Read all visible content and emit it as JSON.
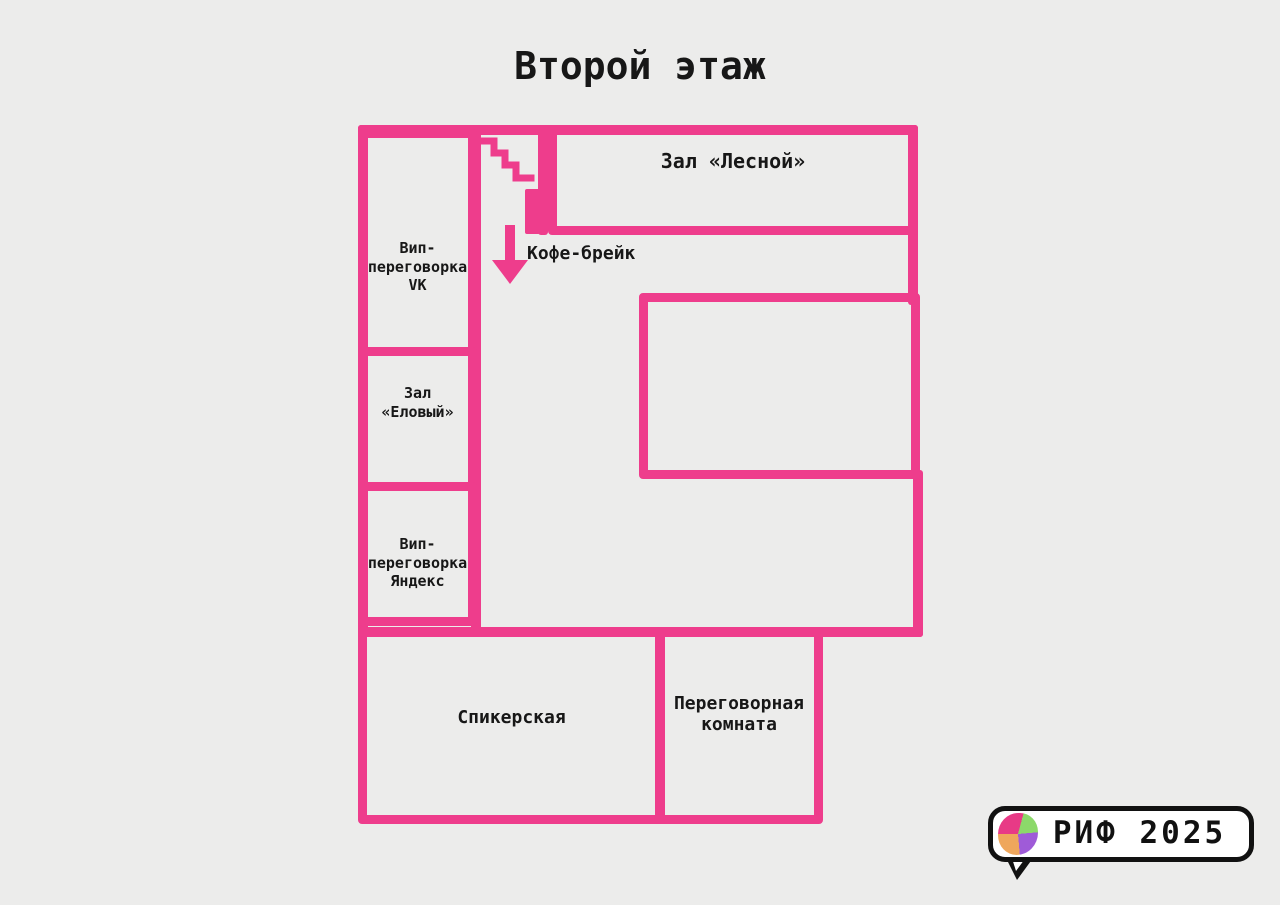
{
  "title": "Второй этаж",
  "colors": {
    "background": "#ececeb",
    "wall_pink": "#ee3d8c",
    "ink": "#171717",
    "logo_bg": "#ffffff",
    "logo_border": "#111111",
    "logo_orange": "#efa75c",
    "logo_pink": "#e83a86",
    "logo_purple": "#9f5bd8",
    "logo_green": "#8cd96a"
  },
  "rooms": {
    "vip_vk": {
      "label": "Вип-\nпереговорка\nVK"
    },
    "zal_elovy": {
      "label": "Зал\n«Еловый»"
    },
    "vip_yandex": {
      "label": "Вип-\nпереговорка\nЯндекс"
    },
    "zal_lesnoy": {
      "label": "Зал «Лесной»"
    },
    "spikerskaya": {
      "label": "Спикерская"
    },
    "peregovornaya": {
      "label": "Переговорная\nкомната"
    }
  },
  "annotations": {
    "coffee_break": "Кофе-брейк"
  },
  "icons": {
    "stairs": "staircase-zigzag",
    "coffee_direction": "down-arrow",
    "door": "door-marker",
    "logo_blob": "pixel-color-wheel"
  },
  "logo": {
    "text": "РИФ 2025"
  }
}
